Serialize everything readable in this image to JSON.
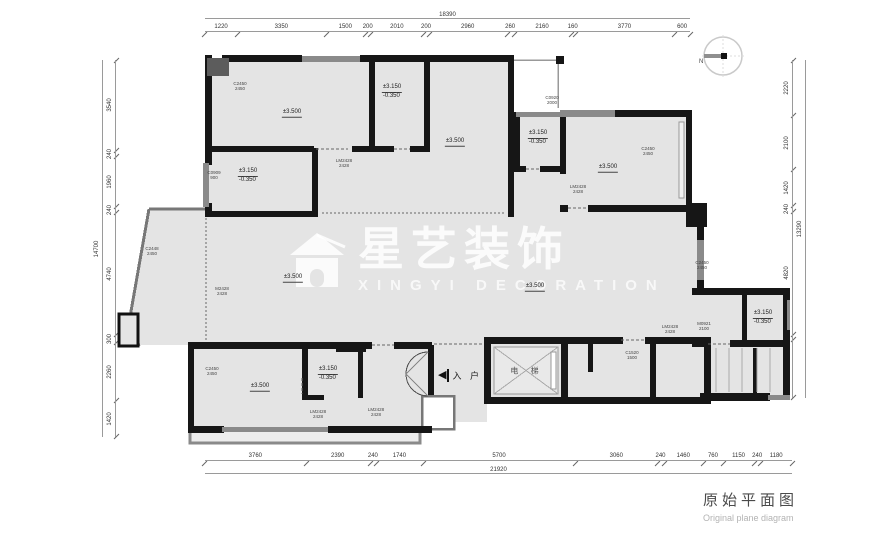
{
  "title": {
    "cn": "原始平面图",
    "en": "Original plane diagram"
  },
  "watermark": {
    "cn": "星艺装饰",
    "en": "XINGYI DECORATION"
  },
  "compass": {
    "label": "N"
  },
  "labels": {
    "entry": "入 户",
    "elevator": "电 梯"
  },
  "dimensions": {
    "top": {
      "total": "18390",
      "segments": [
        "1220",
        "3350",
        "1500",
        "200",
        "2010",
        "200",
        "2960",
        "260",
        "2160",
        "160",
        "3770",
        "600"
      ]
    },
    "bottom": {
      "total": "21920",
      "segments": [
        "3760",
        "2390",
        "240",
        "1740",
        "5700",
        "3060",
        "240",
        "1460",
        "760",
        "1150",
        "240",
        "1180"
      ]
    },
    "left": {
      "total": "14700",
      "segments": [
        "3540",
        "240",
        "1960",
        "240",
        "4740",
        "300",
        "2260",
        "1420"
      ]
    },
    "right": {
      "total": "13290",
      "segments": [
        "2220",
        "2100",
        "1420",
        "240",
        "4820",
        "220",
        "2270"
      ]
    }
  },
  "plan": {
    "levels": [
      {
        "text": "±3.500",
        "x": 292,
        "y": 113
      },
      {
        "text": "±3.500",
        "x": 455,
        "y": 142
      },
      {
        "text": "±3.500",
        "x": 608,
        "y": 168
      },
      {
        "text": "±3.500",
        "x": 293,
        "y": 278
      },
      {
        "text": "±3.500",
        "x": 535,
        "y": 287
      },
      {
        "text": "±3.500",
        "x": 260,
        "y": 387
      },
      {
        "text": "±3.150",
        "sub": "-0.350",
        "x": 248,
        "y": 176
      },
      {
        "text": "±3.150",
        "sub": "-0.350",
        "x": 392,
        "y": 92
      },
      {
        "text": "±3.150",
        "sub": "-0.350",
        "x": 538,
        "y": 138
      },
      {
        "text": "±3.150",
        "sub": "-0.350",
        "x": 328,
        "y": 374
      },
      {
        "text": "±3.150",
        "sub": "-0.350",
        "x": 763,
        "y": 318
      }
    ],
    "codes": [
      {
        "text": "C2450\n2450",
        "x": 240,
        "y": 87
      },
      {
        "text": "C0909\n900",
        "x": 214,
        "y": 176
      },
      {
        "text": "LM2428\n2428",
        "x": 344,
        "y": 164
      },
      {
        "text": "C0920\n2000",
        "x": 552,
        "y": 101
      },
      {
        "text": "C2450\n2450",
        "x": 648,
        "y": 152
      },
      {
        "text": "LM2428\n2428",
        "x": 578,
        "y": 190
      },
      {
        "text": "C2450\n2450",
        "x": 702,
        "y": 266
      },
      {
        "text": "C2448\n2450",
        "x": 152,
        "y": 252
      },
      {
        "text": "M2428\n2428",
        "x": 222,
        "y": 292
      },
      {
        "text": "C2450\n2450",
        "x": 212,
        "y": 372
      },
      {
        "text": "LM2428\n2428",
        "x": 318,
        "y": 415
      },
      {
        "text": "LM2428\n2428",
        "x": 376,
        "y": 413
      },
      {
        "text": "LM2428\n2428",
        "x": 670,
        "y": 330
      },
      {
        "text": "M0921\n2100",
        "x": 704,
        "y": 327
      },
      {
        "text": "C1520\n1500",
        "x": 632,
        "y": 356
      }
    ]
  }
}
